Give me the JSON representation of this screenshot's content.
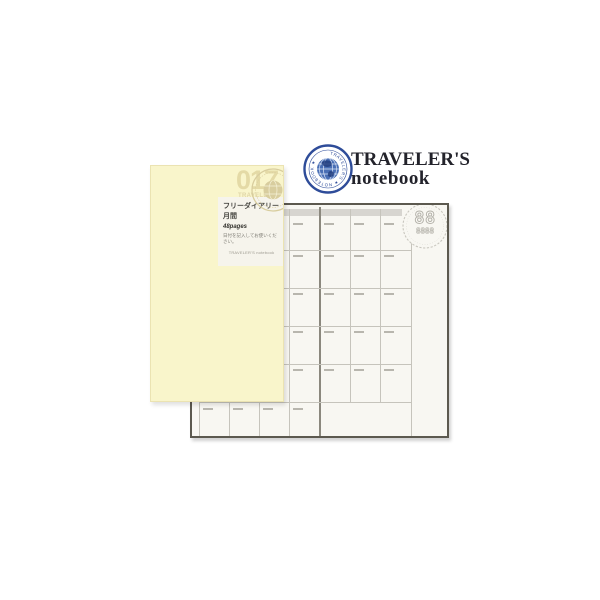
{
  "header": {
    "logo_line1": "TRAVELER'S",
    "logo_line2": "notebook",
    "badge_ring_text": "TRAVELER'S ★ NOTEBOOK ★",
    "badge_color": "#2e4c99"
  },
  "cover": {
    "item_number": "017",
    "brand_line1": "TRAVELER'S",
    "brand_line2": "notebook",
    "color": "#f9f5cb",
    "label": {
      "title": "フリーダイアリー",
      "subtitle": "月間",
      "pages": "48pages",
      "note": "日付を記入してお使いください。",
      "footer": "TRAVELER'S notebook"
    }
  },
  "calendar_page": {
    "month_placeholder": "88",
    "year_placeholder": "8888",
    "grid": {
      "columns": 7,
      "rows": 6,
      "left_page_columns": 4,
      "right_page_columns": 3,
      "header_band": true
    },
    "colors": {
      "page": "#f8f7f2",
      "grid_line": "#c6c4bc",
      "spine": "#8b887e",
      "band": "#d7d5d0",
      "date_dash": "#b8b6ae",
      "border": "#5c594f"
    }
  }
}
